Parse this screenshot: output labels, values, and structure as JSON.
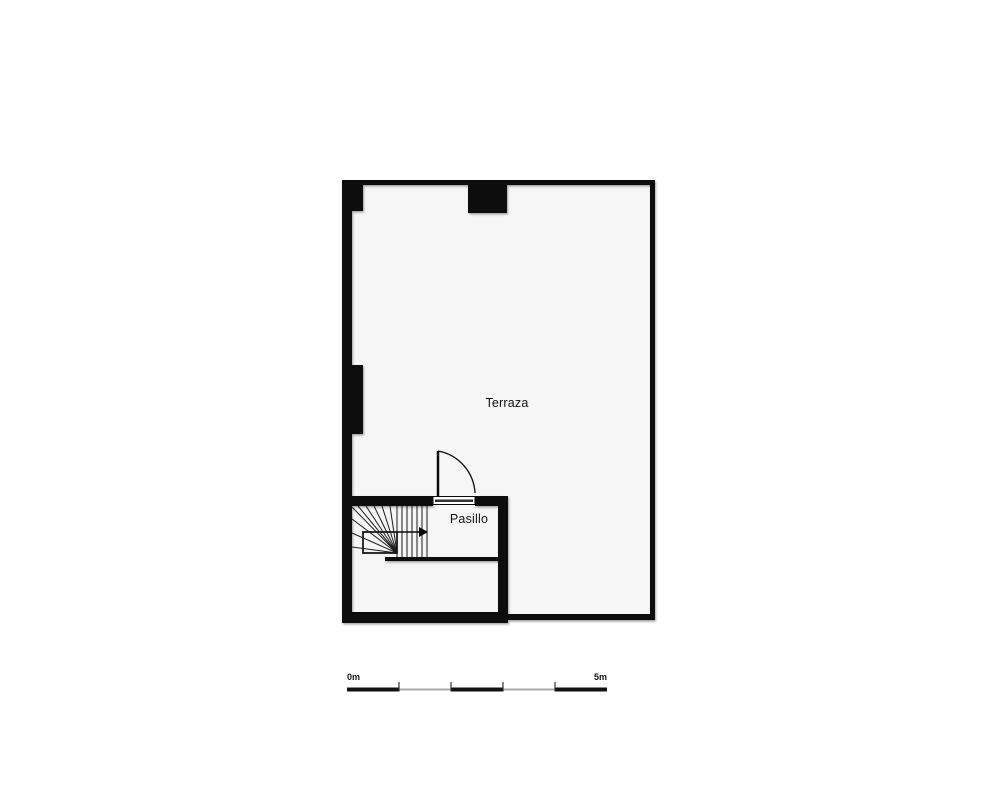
{
  "plan": {
    "rooms": [
      {
        "name": "terraza",
        "label": "Terraza"
      },
      {
        "name": "pasillo",
        "label": "Pasillo"
      }
    ],
    "symbols": [
      "door-swing",
      "winder-staircase",
      "stair-direction-arrow",
      "scale-bar"
    ],
    "colors": {
      "wall": "#0a0a0a",
      "floor": "#f6f6f6",
      "line": "#1a1a1a",
      "scale_black": "#111111",
      "scale_gray": "#aaaaaa",
      "background": "#ffffff"
    }
  },
  "scale_bar": {
    "start_label": "0m",
    "end_label": "5m"
  }
}
